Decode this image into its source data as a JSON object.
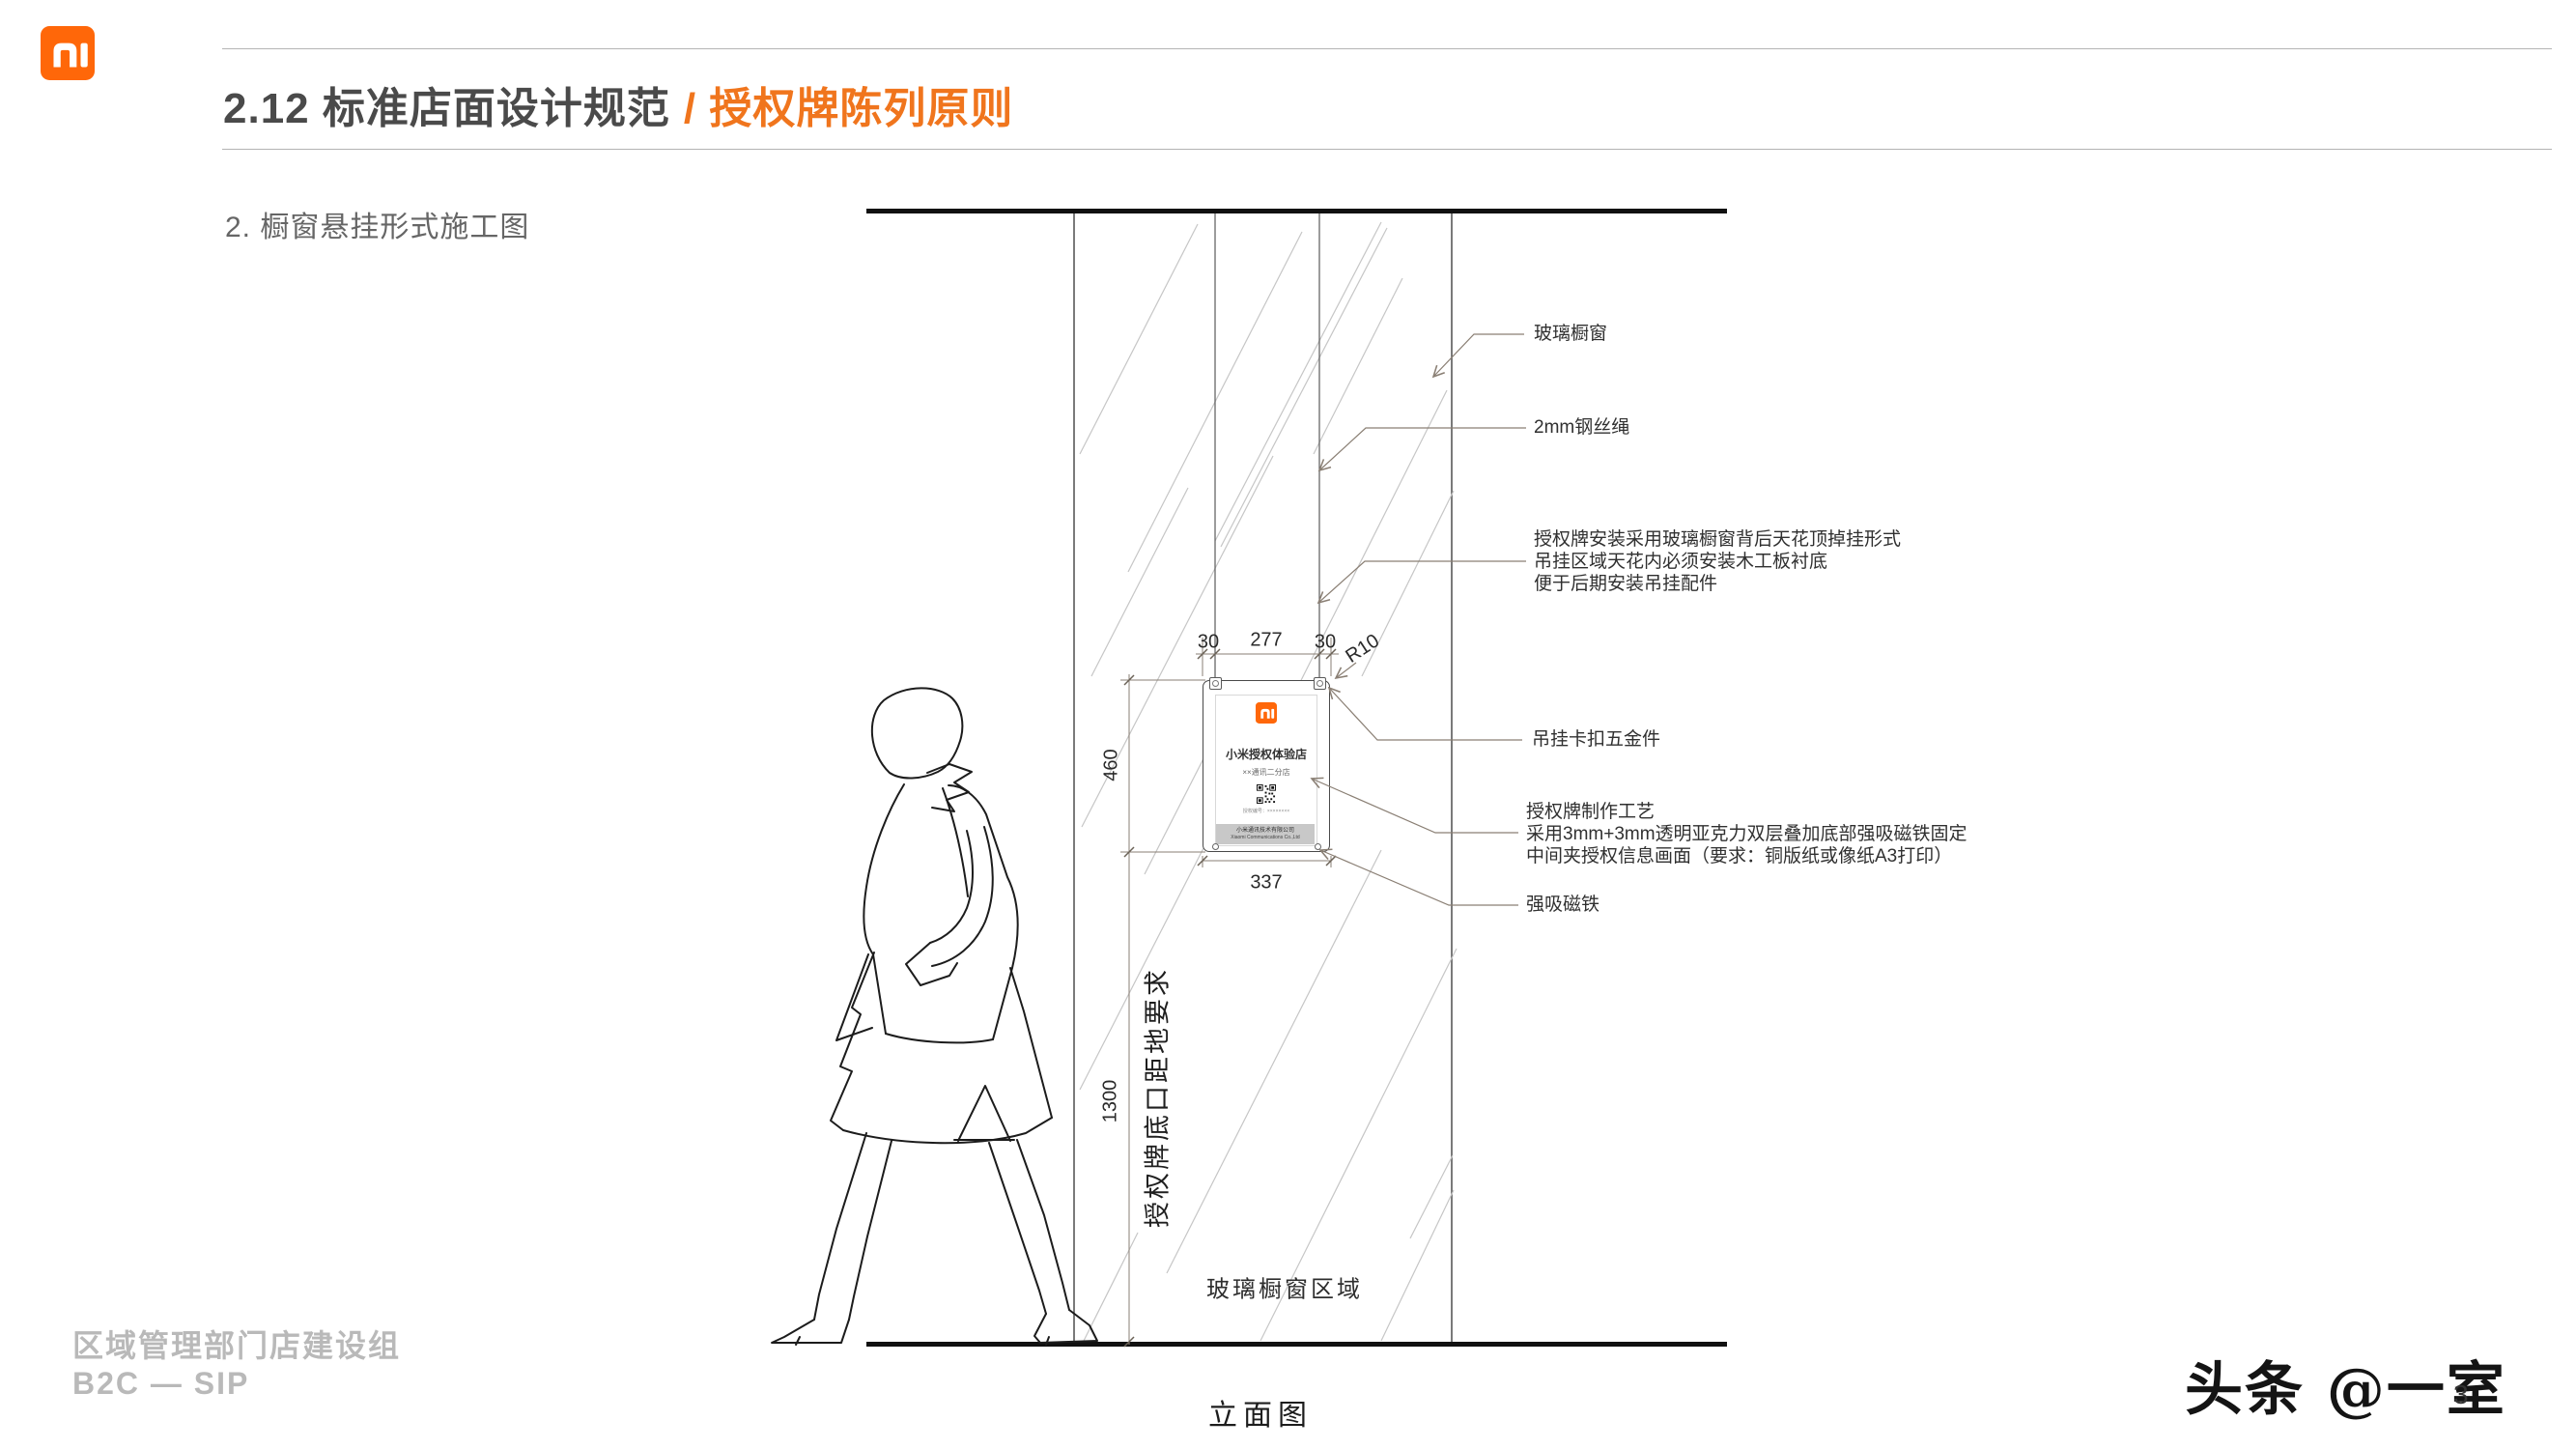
{
  "header": {
    "logo": "xiaomi-mi-logo",
    "title": "2.12 标准店面设计规范",
    "title_accent": "/ 授权牌陈列原则",
    "subtitle": "2. 橱窗悬挂形式施工图"
  },
  "drawing": {
    "caption": "立面图",
    "glass_area_label": "玻璃橱窗区域",
    "height_requirement_label": "授权牌底口距地要求",
    "dims": {
      "offset_left": "30",
      "span_center": "277",
      "offset_right": "30",
      "corner_radius": "R10",
      "plaque_height": "460",
      "plaque_width": "337",
      "bottom_to_floor": "1300"
    },
    "plaque": {
      "store_type": "小米授权体验店",
      "store_name": "××通讯二分店",
      "auth_code": "授权编号：××××××××",
      "company_cn": "小米通讯技术有限公司",
      "company_en": "Xiaomi Communications Co.,Ltd"
    },
    "notes": {
      "glass_window": "玻璃橱窗",
      "steel_wire": "2mm钢丝绳",
      "install": [
        "授权牌安装采用玻璃橱窗背后天花顶掉挂形式",
        "吊挂区域天花内必须安装木工板衬底",
        "便于后期安装吊挂配件"
      ],
      "hook_hardware": "吊挂卡扣五金件",
      "craft": [
        "授权牌制作工艺",
        "采用3mm+3mm透明亚克力双层叠加底部强吸磁铁固定",
        "中间夹授权信息画面（要求：铜版纸或像纸A3打印）"
      ],
      "magnet": "强吸磁铁"
    }
  },
  "footer": {
    "department": "区域管理部门店建设组",
    "channel": "B2C — SIP",
    "watermark": "头条 @一室",
    "page_number": "3"
  },
  "colors": {
    "brand_orange": "#FF6709",
    "accent_orange": "#F0751D",
    "title_gray": "#4A4A4A",
    "leader_brown": "#8A7F74",
    "footer_gray": "#B9B9B9"
  }
}
